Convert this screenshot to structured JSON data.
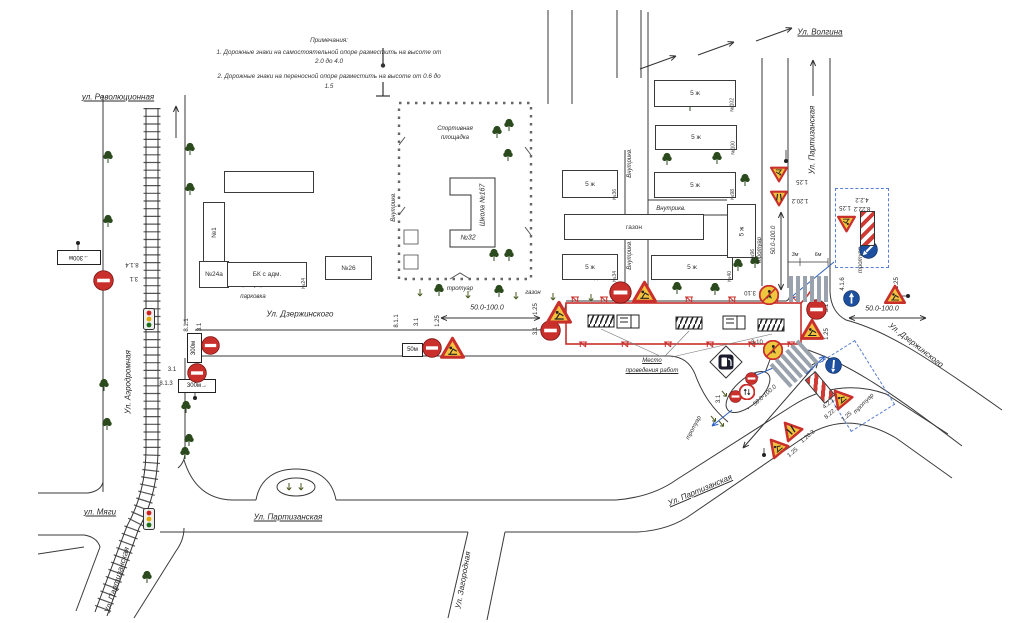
{
  "notes": {
    "title": "Примечания:",
    "line1": "1. Дорожные знаки на самостоятельной опоре разместить на высоте от 2.0 до 4.0",
    "line2": "2. Дорожные знаки на переносной опоре разместить на высоте от 0.6 до 1.5"
  },
  "colors": {
    "work_zone_red": "#c9302c",
    "sign_yellow": "#f2c23e",
    "sign_blue": "#1d4f9f",
    "annotation_blue": "#2b5fc0",
    "tree_green": "#2b4a1d",
    "road_line": "#3a3a3a"
  },
  "streets": [
    {
      "t": "ул. Революционная",
      "x": 118,
      "y": 97,
      "r": 0,
      "u": 1
    },
    {
      "t": "Ул. Волгина",
      "x": 820,
      "y": 32,
      "r": 0,
      "u": 1
    },
    {
      "t": "Ул. Партизанская",
      "x": 812,
      "y": 140,
      "r": -90,
      "u": 0
    },
    {
      "t": "Ул. Дзержинского",
      "x": 300,
      "y": 314,
      "r": 0,
      "u": 0
    },
    {
      "t": "Ул. Дзержинского",
      "x": 916,
      "y": 345,
      "r": 38,
      "u": 0
    },
    {
      "t": "Ул. Аэродромная",
      "x": 128,
      "y": 382,
      "r": -90,
      "u": 0
    },
    {
      "t": "ул. Мяги",
      "x": 100,
      "y": 512,
      "r": 0,
      "u": 1
    },
    {
      "t": "Ул. Партизанская",
      "x": 288,
      "y": 517,
      "r": 0,
      "u": 1
    },
    {
      "t": "Ул. Партизанская",
      "x": 117,
      "y": 580,
      "r": -73,
      "u": 0
    },
    {
      "t": "Ул. Партизанская",
      "x": 700,
      "y": 490,
      "r": -23,
      "u": 1
    },
    {
      "t": "Ул. Загородная",
      "x": 463,
      "y": 580,
      "r": -80,
      "u": 0
    }
  ],
  "labels": [
    {
      "t": "Спортивная",
      "x": 455,
      "y": 129
    },
    {
      "t": "площадка",
      "x": 455,
      "y": 138
    },
    {
      "t": "Школа №167",
      "x": 483,
      "y": 205,
      "r": -90,
      "s": 7
    },
    {
      "t": "№32",
      "x": 468,
      "y": 238,
      "s": 7
    },
    {
      "t": "тротуар",
      "x": 460,
      "y": 289
    },
    {
      "t": "газон",
      "x": 533,
      "y": 293
    },
    {
      "t": "тротуар",
      "x": 251,
      "y": 285
    },
    {
      "t": "парковка",
      "x": 253,
      "y": 297
    },
    {
      "t": "тротуар",
      "x": 760,
      "y": 250,
      "r": -90
    },
    {
      "t": "тротуар",
      "x": 861,
      "y": 260,
      "r": -90
    },
    {
      "t": "тротуар",
      "x": 694,
      "y": 428,
      "r": -62
    },
    {
      "t": "тротуар",
      "x": 864,
      "y": 404,
      "r": -45
    },
    {
      "t": "Внутрикв.",
      "x": 394,
      "y": 207,
      "r": -90
    },
    {
      "t": "Внутрикв.",
      "x": 630,
      "y": 163,
      "r": -90
    },
    {
      "t": "Внутрикв.",
      "x": 671,
      "y": 209
    },
    {
      "t": "Внутрикв.",
      "x": 630,
      "y": 255,
      "r": -90
    },
    {
      "t": "Место",
      "x": 652,
      "y": 361,
      "u": 1
    },
    {
      "t": "проведения работ",
      "x": 652,
      "y": 371,
      "u": 1
    },
    {
      "t": "50.0-100.0",
      "x": 487,
      "y": 308,
      "s": 7
    },
    {
      "t": "50.0-100.0",
      "x": 882,
      "y": 309,
      "s": 7
    },
    {
      "t": "50.0-100.0",
      "x": 774,
      "y": 240,
      "r": -90
    },
    {
      "t": "50.0-100.0",
      "x": 765,
      "y": 396,
      "r": -41
    },
    {
      "t": "3м",
      "x": 795,
      "y": 255,
      "s": 5.5
    },
    {
      "t": "6м",
      "x": 818,
      "y": 255,
      "s": 5.5
    }
  ],
  "sign_labels": [
    {
      "t": "8.1.4",
      "x": 132,
      "y": 264,
      "r": 180
    },
    {
      "t": "3.1",
      "x": 134,
      "y": 278,
      "r": 180
    },
    {
      "t": "8.1.1",
      "x": 187,
      "y": 325,
      "r": -90
    },
    {
      "t": "3.1",
      "x": 200,
      "y": 327,
      "r": -90
    },
    {
      "t": "3.1",
      "x": 172,
      "y": 370
    },
    {
      "t": "8.1.3",
      "x": 166,
      "y": 384
    },
    {
      "t": "8.1.1",
      "x": 397,
      "y": 321,
      "r": -90
    },
    {
      "t": "3.1",
      "x": 417,
      "y": 322,
      "r": -90
    },
    {
      "t": "1.25",
      "x": 438,
      "y": 321,
      "r": -90
    },
    {
      "t": "1.25",
      "x": 536,
      "y": 309,
      "r": -90
    },
    {
      "t": "3.1",
      "x": 536,
      "y": 331,
      "r": -90
    },
    {
      "t": "1.25",
      "x": 597,
      "y": 275,
      "r": -90
    },
    {
      "t": "3.1",
      "x": 609,
      "y": 275,
      "r": -90
    },
    {
      "t": "3.1",
      "x": 827,
      "y": 308,
      "r": -90
    },
    {
      "t": "1.25",
      "x": 827,
      "y": 334,
      "r": -90
    },
    {
      "t": "1.25",
      "x": 802,
      "y": 181,
      "r": 180
    },
    {
      "t": "1.20.2",
      "x": 800,
      "y": 200,
      "r": 180
    },
    {
      "t": "1.25",
      "x": 845,
      "y": 207,
      "r": 180
    },
    {
      "t": "4.2.2",
      "x": 862,
      "y": 199,
      "r": 180
    },
    {
      "t": "8.22.2",
      "x": 862,
      "y": 208,
      "r": 180
    },
    {
      "t": "4.1.6",
      "x": 843,
      "y": 284,
      "r": -90
    },
    {
      "t": "1.25",
      "x": 897,
      "y": 283,
      "r": -90
    },
    {
      "t": "3.10",
      "x": 750,
      "y": 292,
      "r": 180
    },
    {
      "t": "3.10",
      "x": 757,
      "y": 343
    },
    {
      "t": "3.1",
      "x": 719,
      "y": 399,
      "r": -90
    },
    {
      "t": "4.2.1",
      "x": 829,
      "y": 404,
      "r": -40
    },
    {
      "t": "8.22.1",
      "x": 832,
      "y": 413,
      "r": -40
    },
    {
      "t": "1.25",
      "x": 847,
      "y": 417,
      "r": -40
    },
    {
      "t": "1.20.3",
      "x": 808,
      "y": 437,
      "r": -40
    },
    {
      "t": "1.25",
      "x": 793,
      "y": 453,
      "r": -40
    }
  ],
  "plates": [
    {
      "t": "→300м",
      "x": 57,
      "y": 250,
      "w": 42,
      "h": 13,
      "r": 180
    },
    {
      "t": "300м",
      "x": 187,
      "y": 333,
      "w": 13,
      "h": 28,
      "vert": 1
    },
    {
      "t": "300м→",
      "x": 178,
      "y": 379,
      "w": 36,
      "h": 12
    },
    {
      "t": "50м",
      "x": 402,
      "y": 343,
      "w": 19,
      "h": 12
    }
  ],
  "buildings": [
    {
      "x": 203,
      "y": 202,
      "w": 20,
      "h": 58,
      "n": "№1",
      "v": 1
    },
    {
      "x": 199,
      "y": 261,
      "w": 28,
      "h": 25,
      "l": "№24а"
    },
    {
      "x": 227,
      "y": 262,
      "w": 78,
      "h": 23,
      "l": "БК с адм.",
      "n": "№24"
    },
    {
      "x": 325,
      "y": 256,
      "w": 45,
      "h": 22,
      "l": "№26"
    },
    {
      "x": 224,
      "y": 171,
      "w": 88,
      "h": 20,
      "l": ""
    },
    {
      "x": 562,
      "y": 170,
      "w": 54,
      "h": 26,
      "l": "5 ж",
      "n": "№36"
    },
    {
      "x": 654,
      "y": 80,
      "w": 80,
      "h": 25,
      "l": "5 ж",
      "n": "№102"
    },
    {
      "x": 655,
      "y": 125,
      "w": 80,
      "h": 23,
      "l": "5 ж",
      "n": "№100"
    },
    {
      "x": 654,
      "y": 172,
      "w": 80,
      "h": 24,
      "l": "5 ж",
      "n": "№98"
    },
    {
      "x": 562,
      "y": 254,
      "w": 54,
      "h": 24,
      "l": "5 ж",
      "n": "№34"
    },
    {
      "x": 651,
      "y": 255,
      "w": 80,
      "h": 23,
      "l": "5 ж",
      "n": "№40"
    },
    {
      "x": 564,
      "y": 214,
      "w": 138,
      "h": 24,
      "l": "газон"
    },
    {
      "x": 727,
      "y": 204,
      "w": 27,
      "h": 52,
      "l": "5 ж",
      "n": "№96",
      "v": 1
    }
  ],
  "signs": [
    {
      "k": "ne",
      "x": 93,
      "y": 270,
      "s": 21,
      "name": "no-entry-sign-3-1"
    },
    {
      "k": "ne",
      "x": 201,
      "y": 336,
      "s": 19,
      "name": "no-entry-sign-3-1"
    },
    {
      "k": "ne",
      "x": 187,
      "y": 363,
      "s": 20,
      "name": "no-entry-sign-3-1"
    },
    {
      "k": "ne",
      "x": 422,
      "y": 338,
      "s": 20,
      "name": "no-entry-sign-3-1"
    },
    {
      "k": "ne",
      "x": 540,
      "y": 320,
      "s": 21,
      "name": "no-entry-sign-3-1"
    },
    {
      "k": "ne",
      "x": 609,
      "y": 281,
      "s": 23,
      "name": "no-entry-sign-3-1"
    },
    {
      "k": "ne",
      "x": 806,
      "y": 299,
      "s": 21,
      "name": "no-entry-sign-3-1"
    },
    {
      "k": "ne",
      "x": 745,
      "y": 372,
      "s": 13,
      "name": "no-entry-sign-3-1"
    },
    {
      "k": "ne",
      "x": 729,
      "y": 390,
      "s": 13,
      "name": "no-entry-sign-3-1"
    },
    {
      "k": "pa",
      "x": 739,
      "y": 384,
      "s": 16,
      "name": "prohibition-sign"
    },
    {
      "k": "wt",
      "x": 440,
      "y": 336,
      "s": 25,
      "g": "works",
      "name": "roadworks-sign-1-25"
    },
    {
      "k": "wt",
      "x": 632,
      "y": 280,
      "s": 25,
      "g": "works",
      "name": "roadworks-sign-1-25"
    },
    {
      "k": "wt",
      "x": 546,
      "y": 300,
      "s": 26,
      "g": "works",
      "name": "roadworks-sign-1-25"
    },
    {
      "k": "wt",
      "x": 800,
      "y": 318,
      "s": 24,
      "g": "works",
      "name": "roadworks-sign-1-25"
    },
    {
      "k": "wt",
      "x": 884,
      "y": 284,
      "s": 22,
      "g": "works",
      "name": "roadworks-sign-1-25"
    },
    {
      "k": "wt",
      "x": 770,
      "y": 165,
      "s": 18,
      "r": 180,
      "g": "works",
      "name": "roadworks-sign-1-25"
    },
    {
      "k": "wt",
      "x": 770,
      "y": 189,
      "s": 18,
      "r": 180,
      "g": "narrow",
      "name": "road-narrows-sign-1-20-2"
    },
    {
      "k": "wt",
      "x": 837,
      "y": 214,
      "s": 19,
      "r": 180,
      "g": "works",
      "name": "roadworks-sign-1-25"
    },
    {
      "k": "wt",
      "x": 830,
      "y": 387,
      "s": 21,
      "r": -40,
      "g": "works",
      "name": "roadworks-sign-1-25"
    },
    {
      "k": "wt",
      "x": 780,
      "y": 419,
      "s": 21,
      "r": -40,
      "g": "narrow",
      "name": "road-narrows-sign-1-20-3"
    },
    {
      "k": "wt",
      "x": 766,
      "y": 436,
      "s": 21,
      "r": -40,
      "g": "works",
      "name": "roadworks-sign-1-25"
    },
    {
      "k": "yr",
      "x": 759,
      "y": 285,
      "s": 20,
      "name": "no-pedestrians-sign-3-10"
    },
    {
      "k": "yr",
      "x": 763,
      "y": 340,
      "s": 20,
      "name": "no-pedestrians-sign-3-10"
    },
    {
      "k": "br",
      "x": 843,
      "y": 290,
      "s": 17,
      "name": "direction-sign-4-1-6"
    },
    {
      "k": "bd",
      "x": 859,
      "y": 240,
      "s": 19,
      "name": "obstacle-detour-sign-4-2-2"
    },
    {
      "k": "bd",
      "x": 825,
      "y": 357,
      "s": 17,
      "r": -40,
      "name": "obstacle-detour-sign-4-2-1"
    },
    {
      "k": "st",
      "x": 860,
      "y": 211,
      "w": 13,
      "h": 33,
      "name": "obstacle-plate-8-22-2"
    },
    {
      "k": "st",
      "x": 813,
      "y": 372,
      "w": 12,
      "h": 29,
      "r": -40,
      "name": "obstacle-plate-8-22-1"
    },
    {
      "k": "tl",
      "x": 143,
      "y": 308,
      "name": "traffic-light"
    },
    {
      "k": "tl",
      "x": 143,
      "y": 508,
      "name": "traffic-light"
    },
    {
      "k": "gas",
      "x": 709,
      "y": 345,
      "s": 34,
      "name": "gas-station-symbol"
    },
    {
      "k": "cw",
      "x": 789,
      "y": 276,
      "w": 47,
      "h": 26,
      "r": 0,
      "name": "crosswalk"
    },
    {
      "k": "cw",
      "x": 774,
      "y": 347,
      "w": 44,
      "h": 30,
      "r": -42,
      "name": "crosswalk"
    }
  ],
  "trees": [
    [
      108,
      156
    ],
    [
      108,
      220
    ],
    [
      190,
      148
    ],
    [
      190,
      188
    ],
    [
      104,
      384
    ],
    [
      107,
      423
    ],
    [
      186,
      406
    ],
    [
      189,
      439
    ],
    [
      185,
      452
    ],
    [
      147,
      576
    ],
    [
      497,
      131
    ],
    [
      509,
      124
    ],
    [
      508,
      154
    ],
    [
      494,
      254
    ],
    [
      509,
      254
    ],
    [
      439,
      289
    ],
    [
      499,
      290
    ],
    [
      677,
      287
    ],
    [
      715,
      288
    ],
    [
      690,
      104
    ],
    [
      667,
      158
    ],
    [
      717,
      157
    ],
    [
      745,
      179
    ],
    [
      755,
      261
    ],
    [
      738,
      264
    ]
  ],
  "fences": {
    "top_y": 297,
    "top_x": [
      575,
      604,
      646,
      689,
      732,
      775,
      795
    ],
    "bot_y": 342,
    "bot_x": [
      583,
      625,
      668,
      710,
      752,
      791
    ]
  },
  "arrows": [
    {
      "x1": 176,
      "y1": 138,
      "x2": 176,
      "y2": 106
    },
    {
      "x1": 813,
      "y1": 96,
      "x2": 813,
      "y2": 60
    },
    {
      "x1": 640,
      "y1": 69,
      "x2": 676,
      "y2": 56
    },
    {
      "x1": 698,
      "y1": 55,
      "x2": 734,
      "y2": 42
    },
    {
      "x1": 756,
      "y1": 41,
      "x2": 792,
      "y2": 28
    },
    {
      "x1": 441,
      "y1": 318,
      "x2": 540,
      "y2": 318,
      "both": 1
    },
    {
      "x1": 849,
      "y1": 318,
      "x2": 926,
      "y2": 318,
      "both": 1
    },
    {
      "x1": 781,
      "y1": 212,
      "x2": 781,
      "y2": 290,
      "both": 1
    },
    {
      "x1": 818,
      "y1": 362,
      "x2": 743,
      "y2": 448,
      "both": 1
    }
  ],
  "blue_arrows": [
    {
      "x1": 834,
      "y1": 262,
      "x2": 789,
      "y2": 299
    },
    {
      "x1": 806,
      "y1": 374,
      "x2": 825,
      "y2": 356
    },
    {
      "x1": 773,
      "y1": 368,
      "x2": 752,
      "y2": 377
    },
    {
      "x1": 732,
      "y1": 410,
      "x2": 712,
      "y2": 426
    }
  ],
  "small_arrows": [
    [
      420,
      289,
      0
    ],
    [
      468,
      291,
      0
    ],
    [
      516,
      292,
      0
    ],
    [
      553,
      293,
      0
    ],
    [
      591,
      294,
      0
    ],
    [
      722,
      391,
      -40
    ],
    [
      730,
      396,
      -40
    ],
    [
      711,
      416,
      -40
    ],
    [
      719,
      421,
      -40
    ],
    [
      289,
      483,
      0
    ],
    [
      301,
      483,
      0
    ]
  ],
  "dots": [
    [
      78,
      243
    ],
    [
      195,
      398
    ],
    [
      764,
      455
    ],
    [
      786,
      161
    ],
    [
      908,
      296
    ]
  ],
  "poles": [
    [
      78,
      243,
      78,
      251
    ],
    [
      195,
      392,
      195,
      398
    ],
    [
      764,
      448,
      764,
      455
    ],
    [
      786,
      150,
      786,
      163
    ],
    [
      896,
      296,
      906,
      296
    ]
  ]
}
